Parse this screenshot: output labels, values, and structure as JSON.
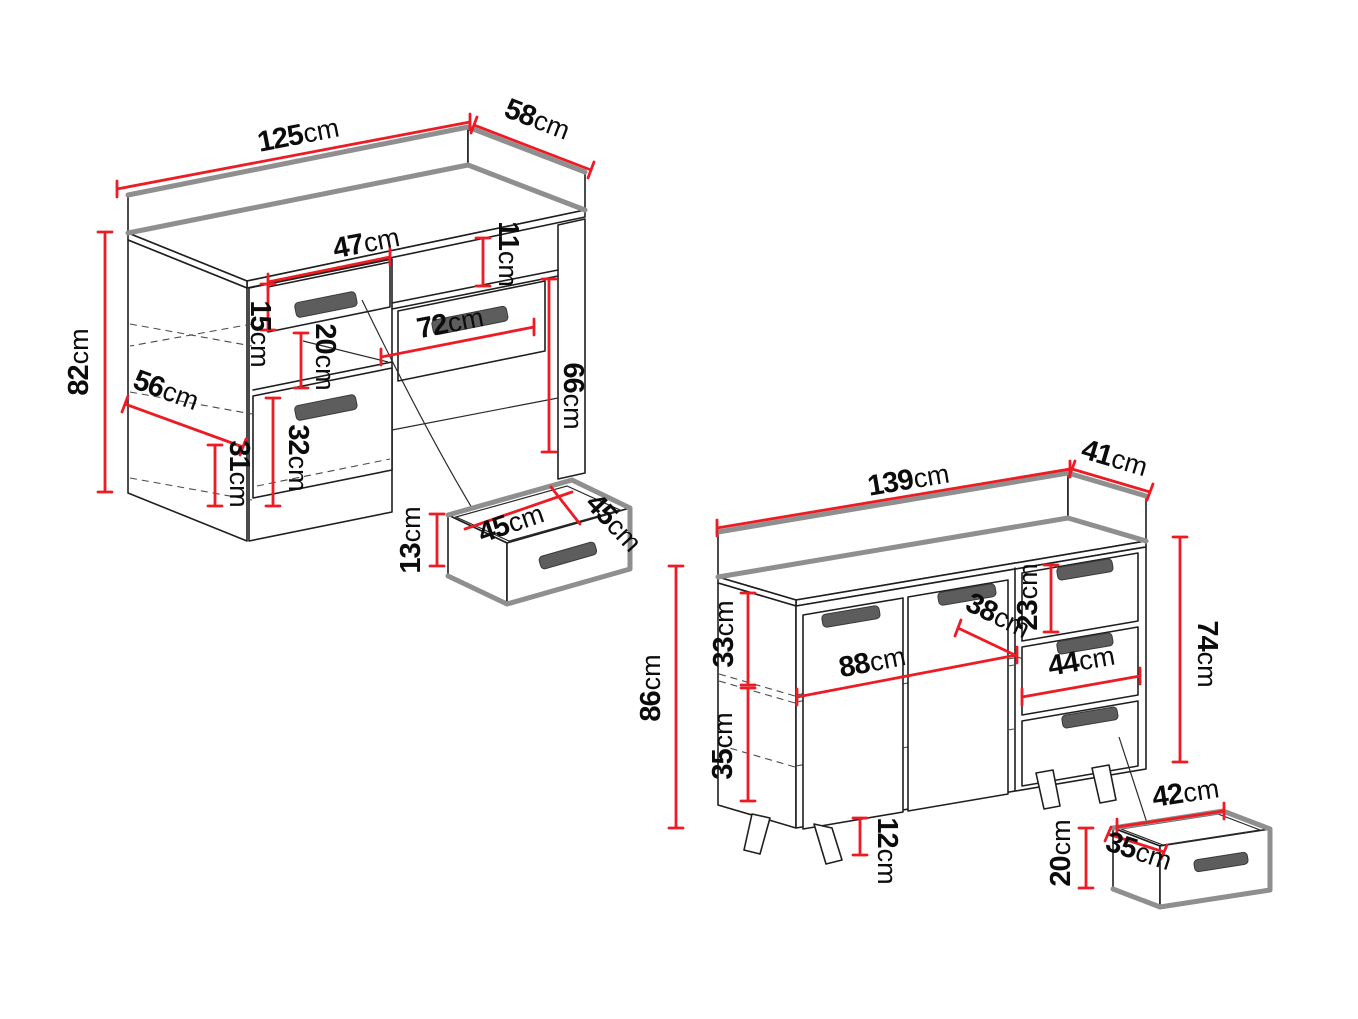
{
  "figure": {
    "background": "#ffffff",
    "dimension_line_color": "#ED1B24",
    "outline_color": "#1f1f1f",
    "thick_edge_color": "#8f8f8f",
    "handle_color": "#5d5d5d",
    "unit": "cm"
  },
  "desk": {
    "dims": {
      "width": {
        "value": "125",
        "unit": "cm"
      },
      "depth": {
        "value": "58",
        "unit": "cm"
      },
      "height": {
        "value": "82",
        "unit": "cm"
      },
      "drawer_width": {
        "value": "47",
        "unit": "cm"
      },
      "drawer_height": {
        "value": "15",
        "unit": "cm"
      },
      "niche_height": {
        "value": "11",
        "unit": "cm"
      },
      "shelf_opening": {
        "value": "20",
        "unit": "cm"
      },
      "door_height": {
        "value": "32",
        "unit": "cm"
      },
      "inner_depth": {
        "value": "56",
        "unit": "cm"
      },
      "inner_bottom": {
        "value": "31",
        "unit": "cm"
      },
      "knee_width": {
        "value": "72",
        "unit": "cm"
      },
      "knee_height": {
        "value": "66",
        "unit": "cm"
      },
      "pullout_height": {
        "value": "13",
        "unit": "cm"
      },
      "pullout_width": {
        "value": "45",
        "unit": "cm"
      },
      "pullout_depth": {
        "value": "45",
        "unit": "cm"
      }
    }
  },
  "sideboard": {
    "dims": {
      "width": {
        "value": "139",
        "unit": "cm"
      },
      "depth": {
        "value": "41",
        "unit": "cm"
      },
      "height": {
        "value": "86",
        "unit": "cm"
      },
      "carcass_height": {
        "value": "74",
        "unit": "cm"
      },
      "upper_inner": {
        "value": "33",
        "unit": "cm"
      },
      "lower_inner": {
        "value": "35",
        "unit": "cm"
      },
      "door_section": {
        "value": "88",
        "unit": "cm"
      },
      "inner_depth": {
        "value": "38",
        "unit": "cm"
      },
      "top_drawer": {
        "value": "23",
        "unit": "cm"
      },
      "drawer_width": {
        "value": "44",
        "unit": "cm"
      },
      "leg_height": {
        "value": "12",
        "unit": "cm"
      },
      "pullout_width": {
        "value": "42",
        "unit": "cm"
      },
      "pullout_depth": {
        "value": "35",
        "unit": "cm"
      },
      "pullout_height": {
        "value": "20",
        "unit": "cm"
      }
    }
  }
}
